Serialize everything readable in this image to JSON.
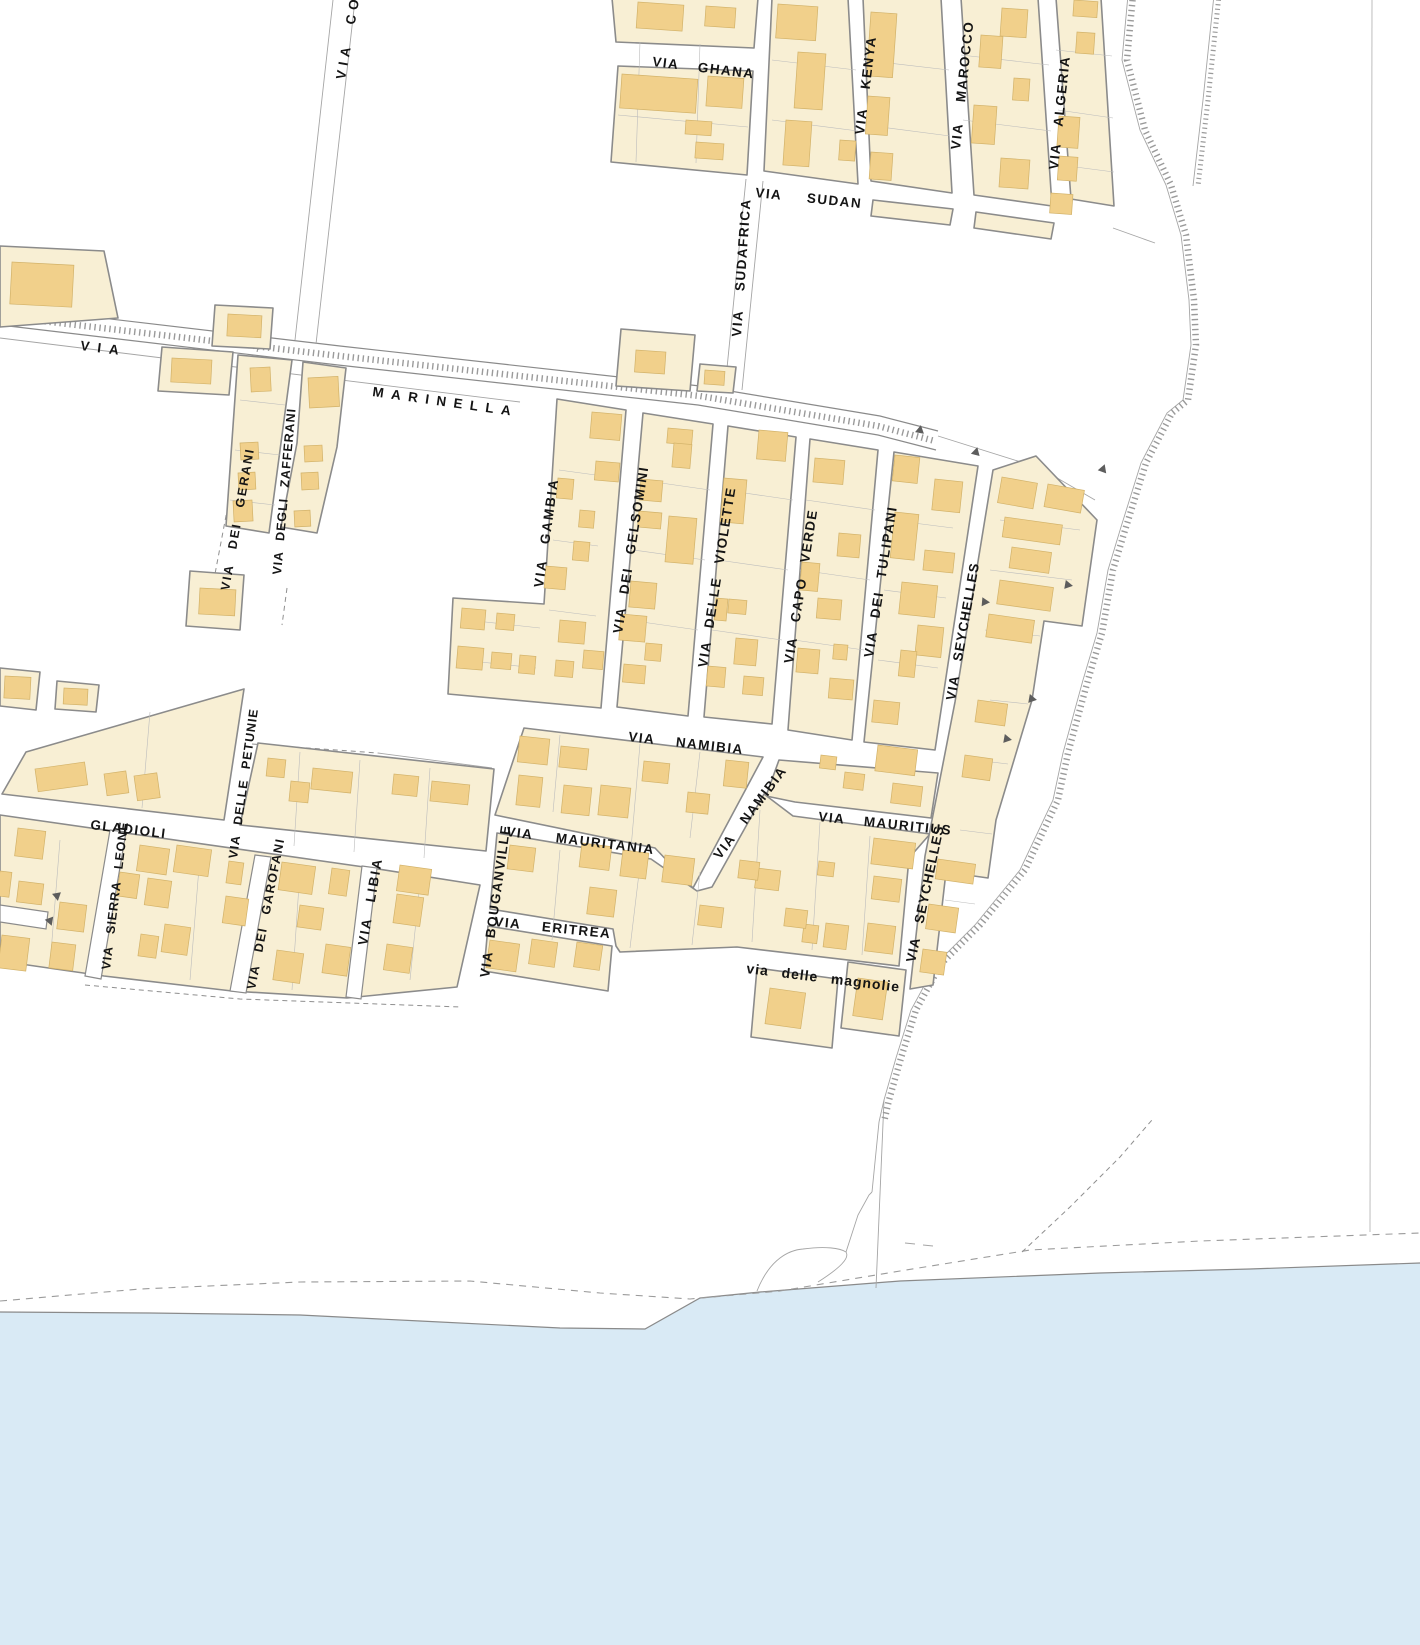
{
  "map": {
    "type": "cadastral-street-map",
    "colors": {
      "background": "#ffffff",
      "parcel_fill": "#f8efd4",
      "building_fill": "#f1d08b",
      "water_fill": "#d9eaf5",
      "outline_gray": "#8b8b8b",
      "label_color": "#141414"
    },
    "streets": [
      {
        "id": "via-co",
        "label": "VIA CO"
      },
      {
        "id": "via-ghana",
        "label": "VIA GHANA"
      },
      {
        "id": "via-kenya",
        "label": "VIA KENYA"
      },
      {
        "id": "via-marocco",
        "label": "VIA MAROCCO"
      },
      {
        "id": "via-algeria",
        "label": "VIA ALGERIA"
      },
      {
        "id": "via-sudan",
        "label": "VIA SUDAN"
      },
      {
        "id": "via-sudafrica",
        "label": "VIA SUDAFRICA"
      },
      {
        "id": "via-marinella-via",
        "label": "VIA"
      },
      {
        "id": "via-marinella",
        "label": "MARINELLA"
      },
      {
        "id": "via-dei-gerani",
        "label": "VIA DEI GERANI"
      },
      {
        "id": "via-degli-zafferani",
        "label": "VIA DEGLI ZAFFERANI"
      },
      {
        "id": "via-gambia",
        "label": "VIA GAMBIA"
      },
      {
        "id": "via-dei-gelsomini",
        "label": "VIA DEI GELSOMINI"
      },
      {
        "id": "via-delle-violette",
        "label": "VIA DELLE VIOLETTE"
      },
      {
        "id": "via-capo-verde",
        "label": "VIA CAPO VERDE"
      },
      {
        "id": "via-dei-tulipani",
        "label": "VIA DEI TULIPANI"
      },
      {
        "id": "via-seychelles-upper",
        "label": "VIA SEYCHELLES"
      },
      {
        "id": "via-namibia-horizontal",
        "label": "VIA NAMIBIA"
      },
      {
        "id": "via-namibia-diagonal",
        "label": "VIA NAMIBIA"
      },
      {
        "id": "via-mauritania",
        "label": "VIA MAURITANIA"
      },
      {
        "id": "via-bouganville",
        "label": "VIA BOUGANVILLE"
      },
      {
        "id": "via-eritrea",
        "label": "VIA ERITREA"
      },
      {
        "id": "via-dei-gladioli",
        "label": "GLADIOLI"
      },
      {
        "id": "via-delle-petunie",
        "label": "VIA DELLE PETUNIE"
      },
      {
        "id": "via-sierra-leone",
        "label": "VIA SIERRA LEONE"
      },
      {
        "id": "via-dei-garofani",
        "label": "VIA DEI GAROFANI"
      },
      {
        "id": "via-libia",
        "label": "VIA LIBIA"
      },
      {
        "id": "via-mauritius",
        "label": "VIA MAURITIUS"
      },
      {
        "id": "via-seychelles-lower",
        "label": "VIA SEYCHELLES"
      },
      {
        "id": "via-delle-magnolie",
        "label": "via delle magnolie"
      }
    ]
  }
}
